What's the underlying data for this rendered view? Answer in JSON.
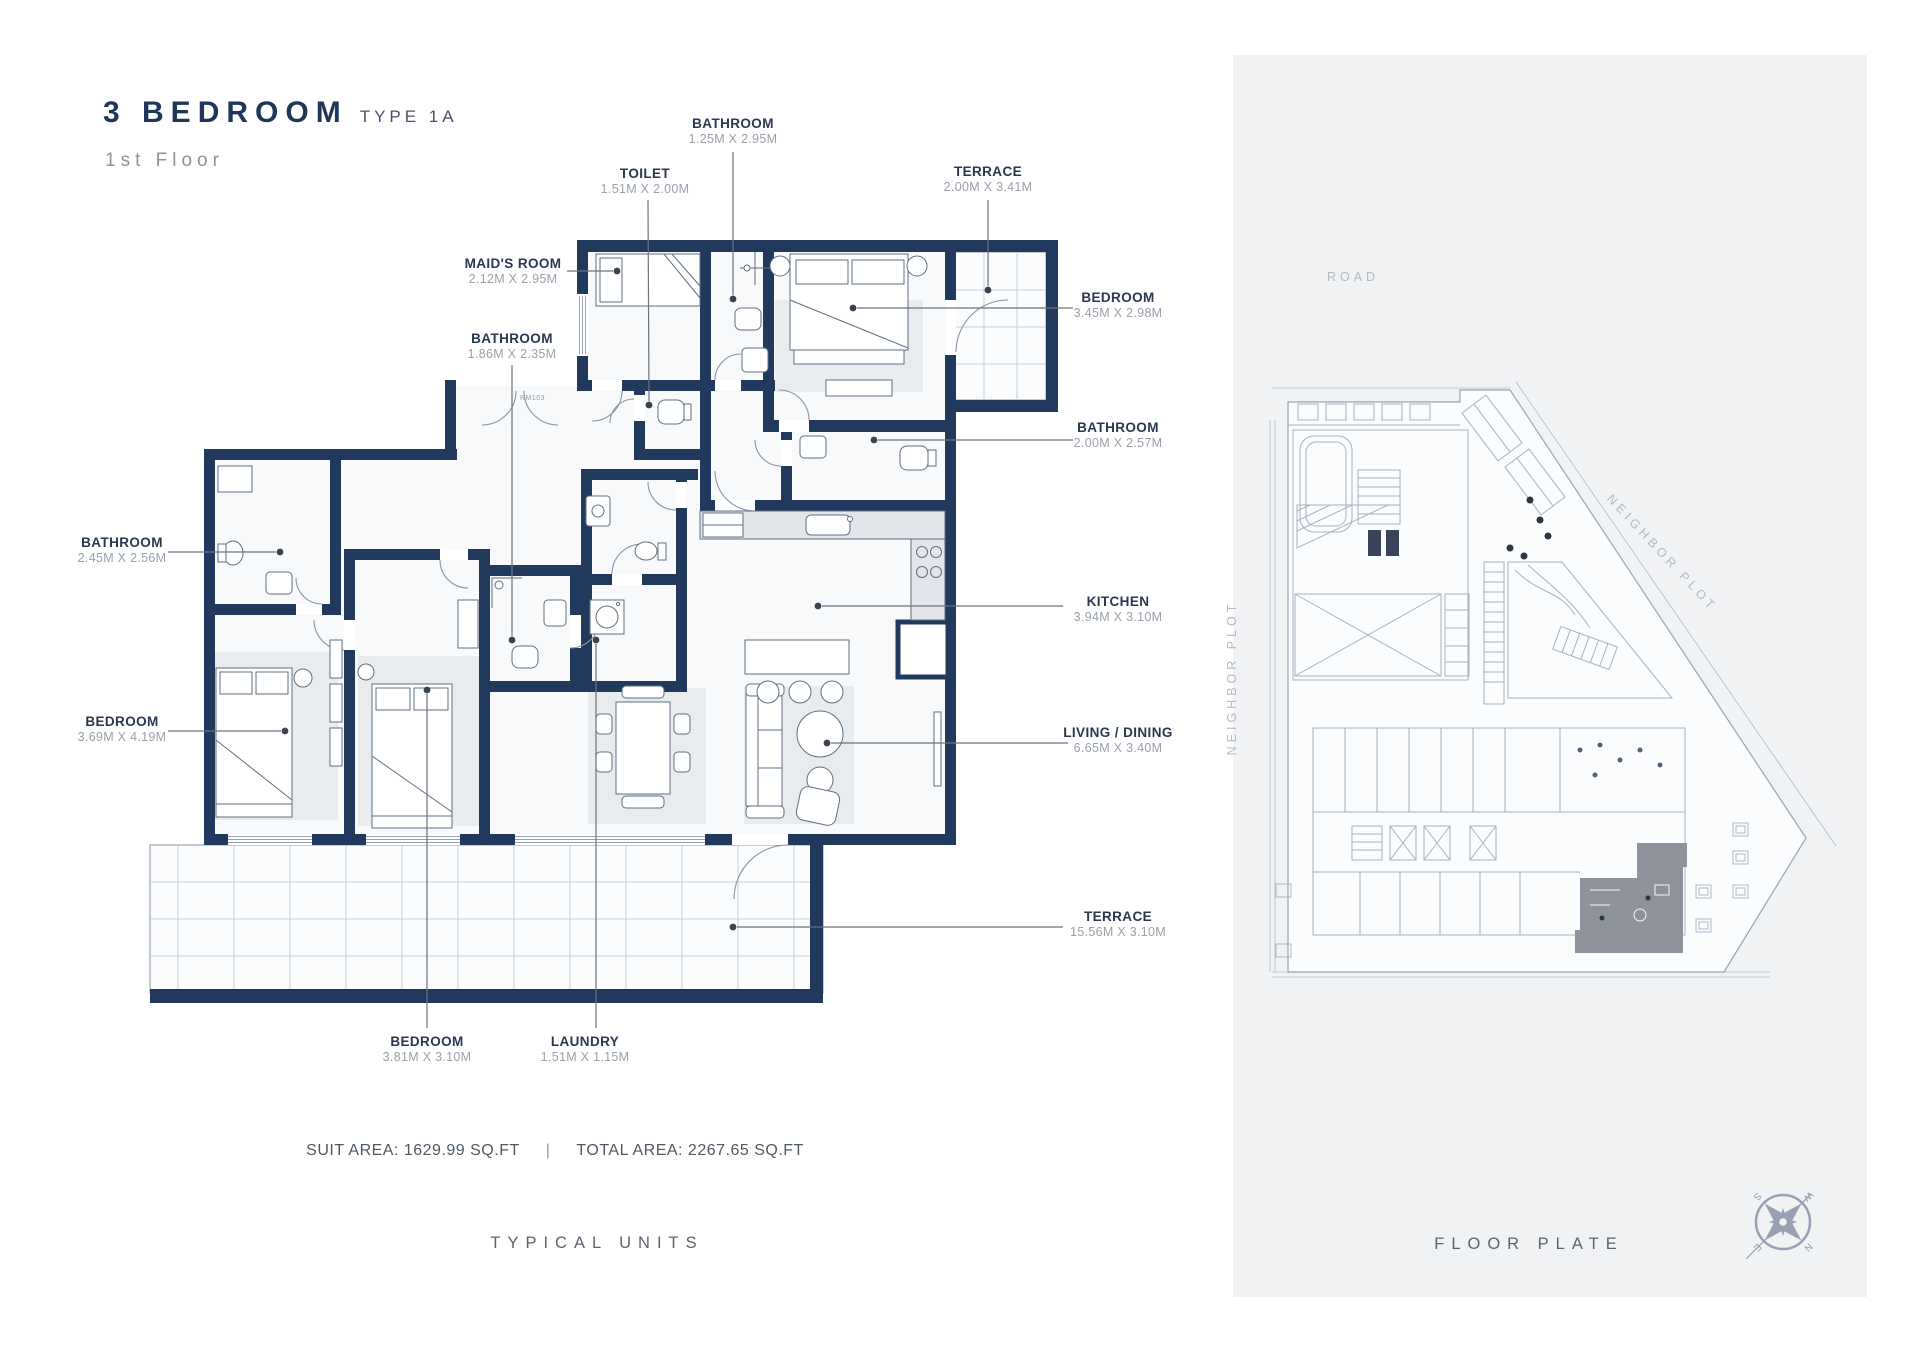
{
  "title": {
    "main": "3 BEDROOM",
    "type": "TYPE 1A",
    "floor": "1st Floor"
  },
  "unit_plan": {
    "caption": "TYPICAL UNITS",
    "plan_note": "RM103",
    "stats": {
      "suit_area": "SUIT AREA: 1629.99 SQ.FT",
      "separator": "|",
      "total_area": "TOTAL AREA: 2267.65 SQ.FT"
    },
    "rooms": [
      {
        "name": "BATHROOM",
        "dims": "1.25M X 2.95M"
      },
      {
        "name": "TOILET",
        "dims": "1.51M X 2.00M"
      },
      {
        "name": "TERRACE",
        "dims": "2.00M X 3.41M"
      },
      {
        "name": "MAID'S ROOM",
        "dims": "2.12M X 2.95M"
      },
      {
        "name": "BEDROOM",
        "dims": "3.45M X 2.98M"
      },
      {
        "name": "BATHROOM",
        "dims": "1.86M X 2.35M"
      },
      {
        "name": "BATHROOM",
        "dims": "2.00M X 2.57M"
      },
      {
        "name": "BATHROOM",
        "dims": "2.45M X 2.56M"
      },
      {
        "name": "KITCHEN",
        "dims": "3.94M X 3.10M"
      },
      {
        "name": "BEDROOM",
        "dims": "3.69M X 4.19M"
      },
      {
        "name": "LIVING / DINING",
        "dims": "6.65M X 3.40M"
      },
      {
        "name": "TERRACE",
        "dims": "15.56M X 3.10M"
      },
      {
        "name": "BEDROOM",
        "dims": "3.81M X 3.10M"
      },
      {
        "name": "LAUNDRY",
        "dims": "1.51M X 1.15M"
      }
    ]
  },
  "floor_plate": {
    "caption": "FLOOR PLATE",
    "road_label": "ROAD",
    "neighbor_left": "NEIGHBOR PLOT",
    "neighbor_right": "NEIGHBOR PLOT",
    "compass": {
      "n": "N",
      "e": "E",
      "s": "S",
      "w": "W"
    }
  },
  "colors": {
    "wall_navy": "#21395c",
    "panel_bg": "#f1f2f4",
    "label_text": "#2a3850",
    "dim_text": "#9aa1ab",
    "plate_line": "#a9b2c1",
    "highlight_unit": "#8e939b"
  }
}
